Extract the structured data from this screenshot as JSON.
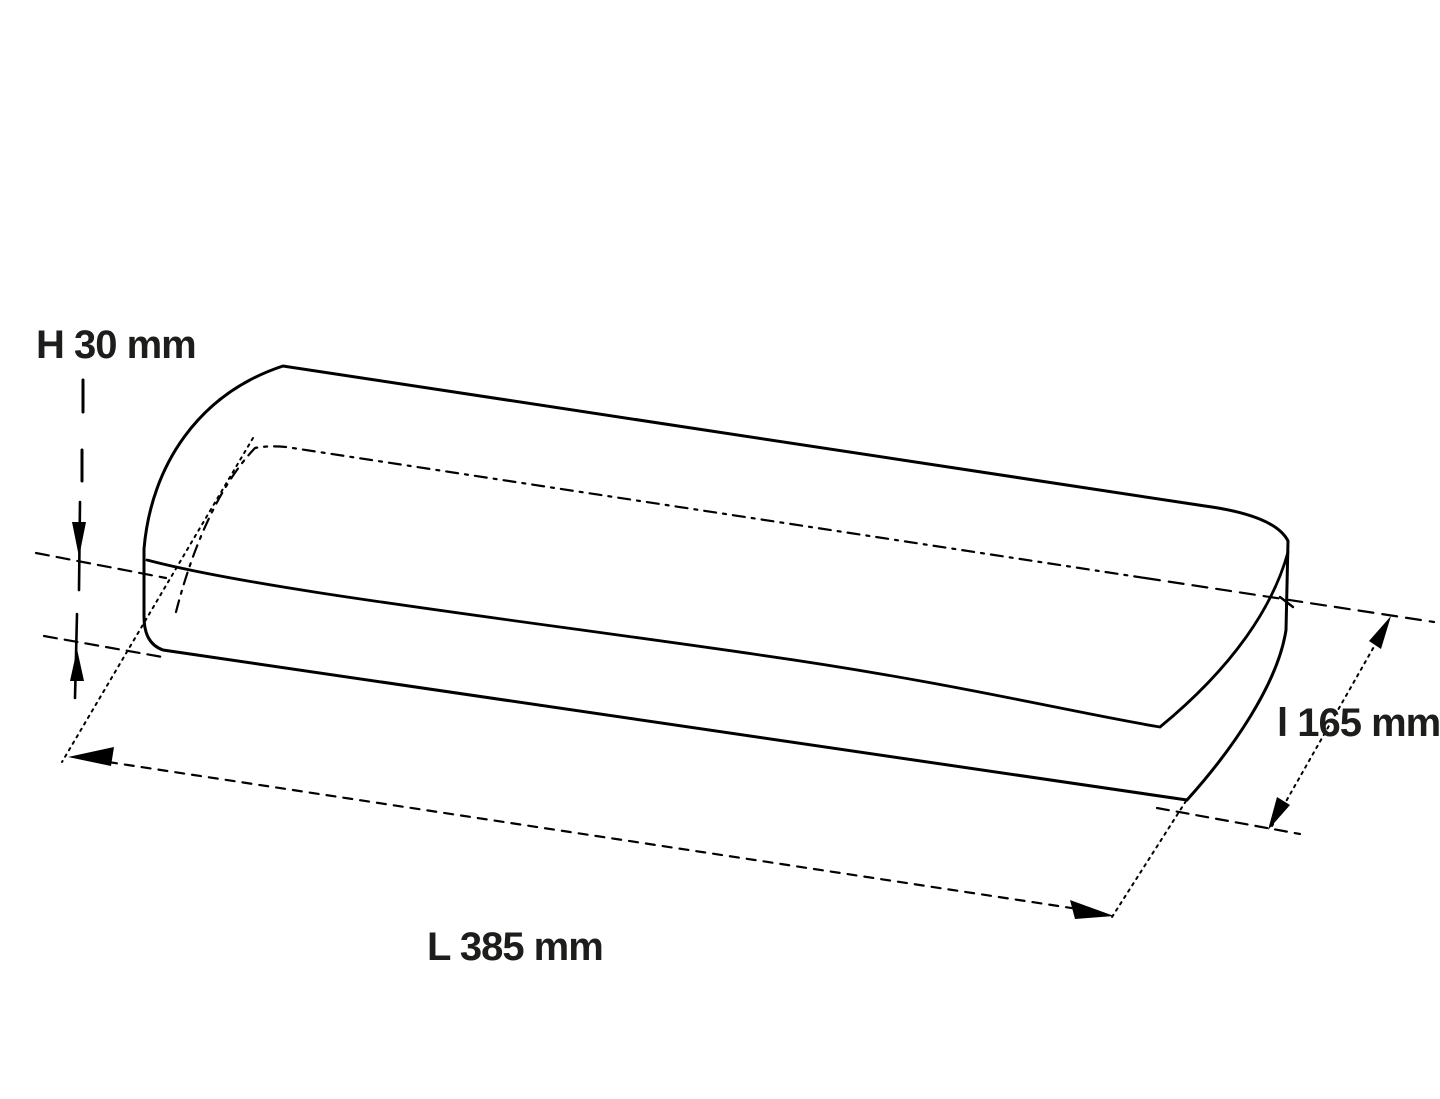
{
  "diagram": {
    "type": "technical-dimension-drawing",
    "subject": "rounded rectangular slab shown in perspective",
    "dimensions": {
      "height": {
        "label": "H 30 mm",
        "letter": "H",
        "value": 30,
        "unit": "mm"
      },
      "width": {
        "label": "l 165 mm",
        "letter": "l",
        "value": 165,
        "unit": "mm"
      },
      "length": {
        "label": "L 385 mm",
        "letter": "L",
        "value": 385,
        "unit": "mm"
      }
    }
  },
  "colors": {
    "background": "#ffffff",
    "line": "#000000",
    "text": "#1d1d1b"
  }
}
